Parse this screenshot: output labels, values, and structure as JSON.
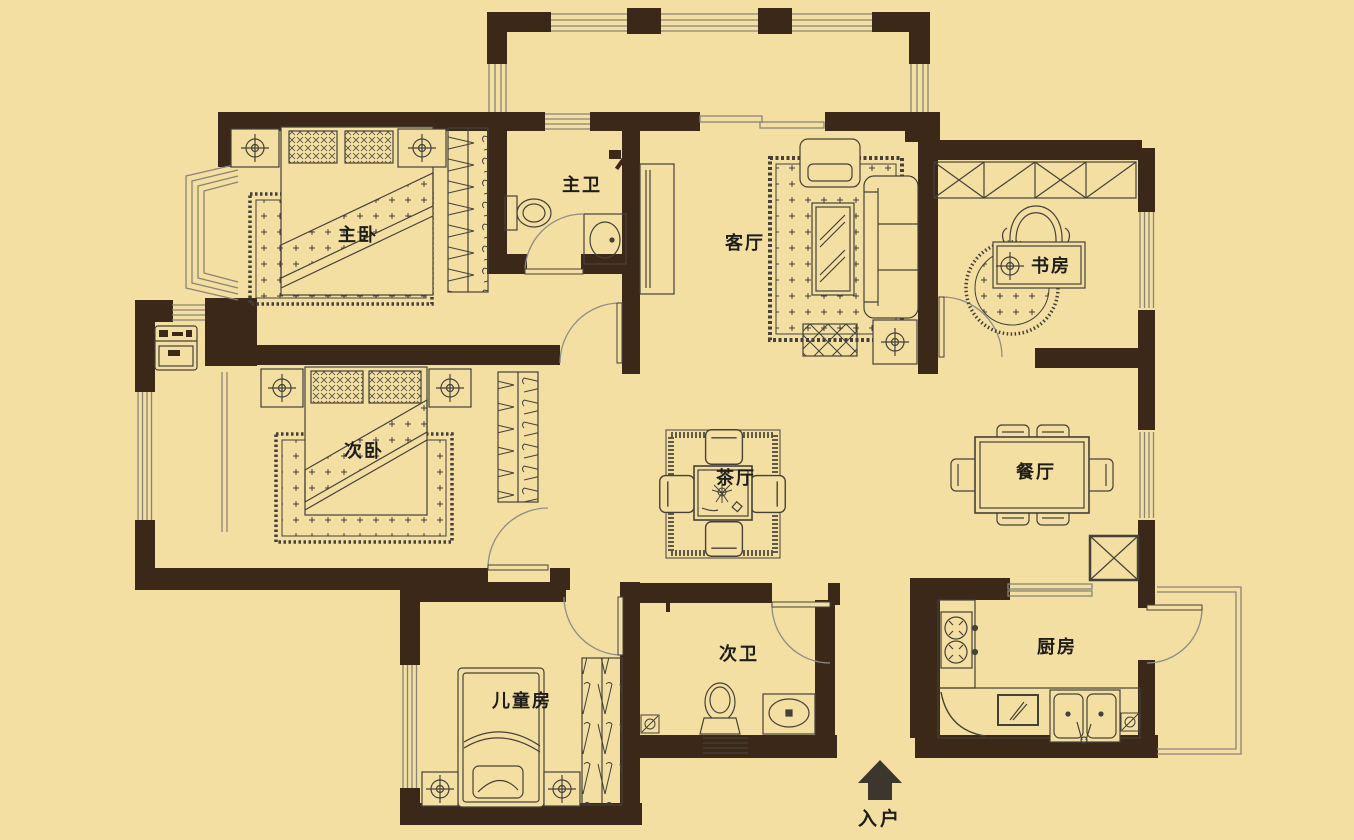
{
  "plan": {
    "rooms": {
      "master_bedroom": "主卧",
      "master_bath": "主卫",
      "living_room": "客厅",
      "study": "书房",
      "second_bedroom": "次卧",
      "tea_room": "茶厅",
      "dining_room": "餐厅",
      "children_room": "儿童房",
      "second_bath": "次卫",
      "kitchen": "厨房"
    },
    "entrance_label": "入户",
    "colors": {
      "background": "#F3DFA2",
      "wall": "#3B2819",
      "furniture_line": "#45413A",
      "door_arc": "#8E8E86",
      "window_line": "#8A8478",
      "text": "#1F1D18",
      "entry_arrow": "#3C362E"
    }
  }
}
